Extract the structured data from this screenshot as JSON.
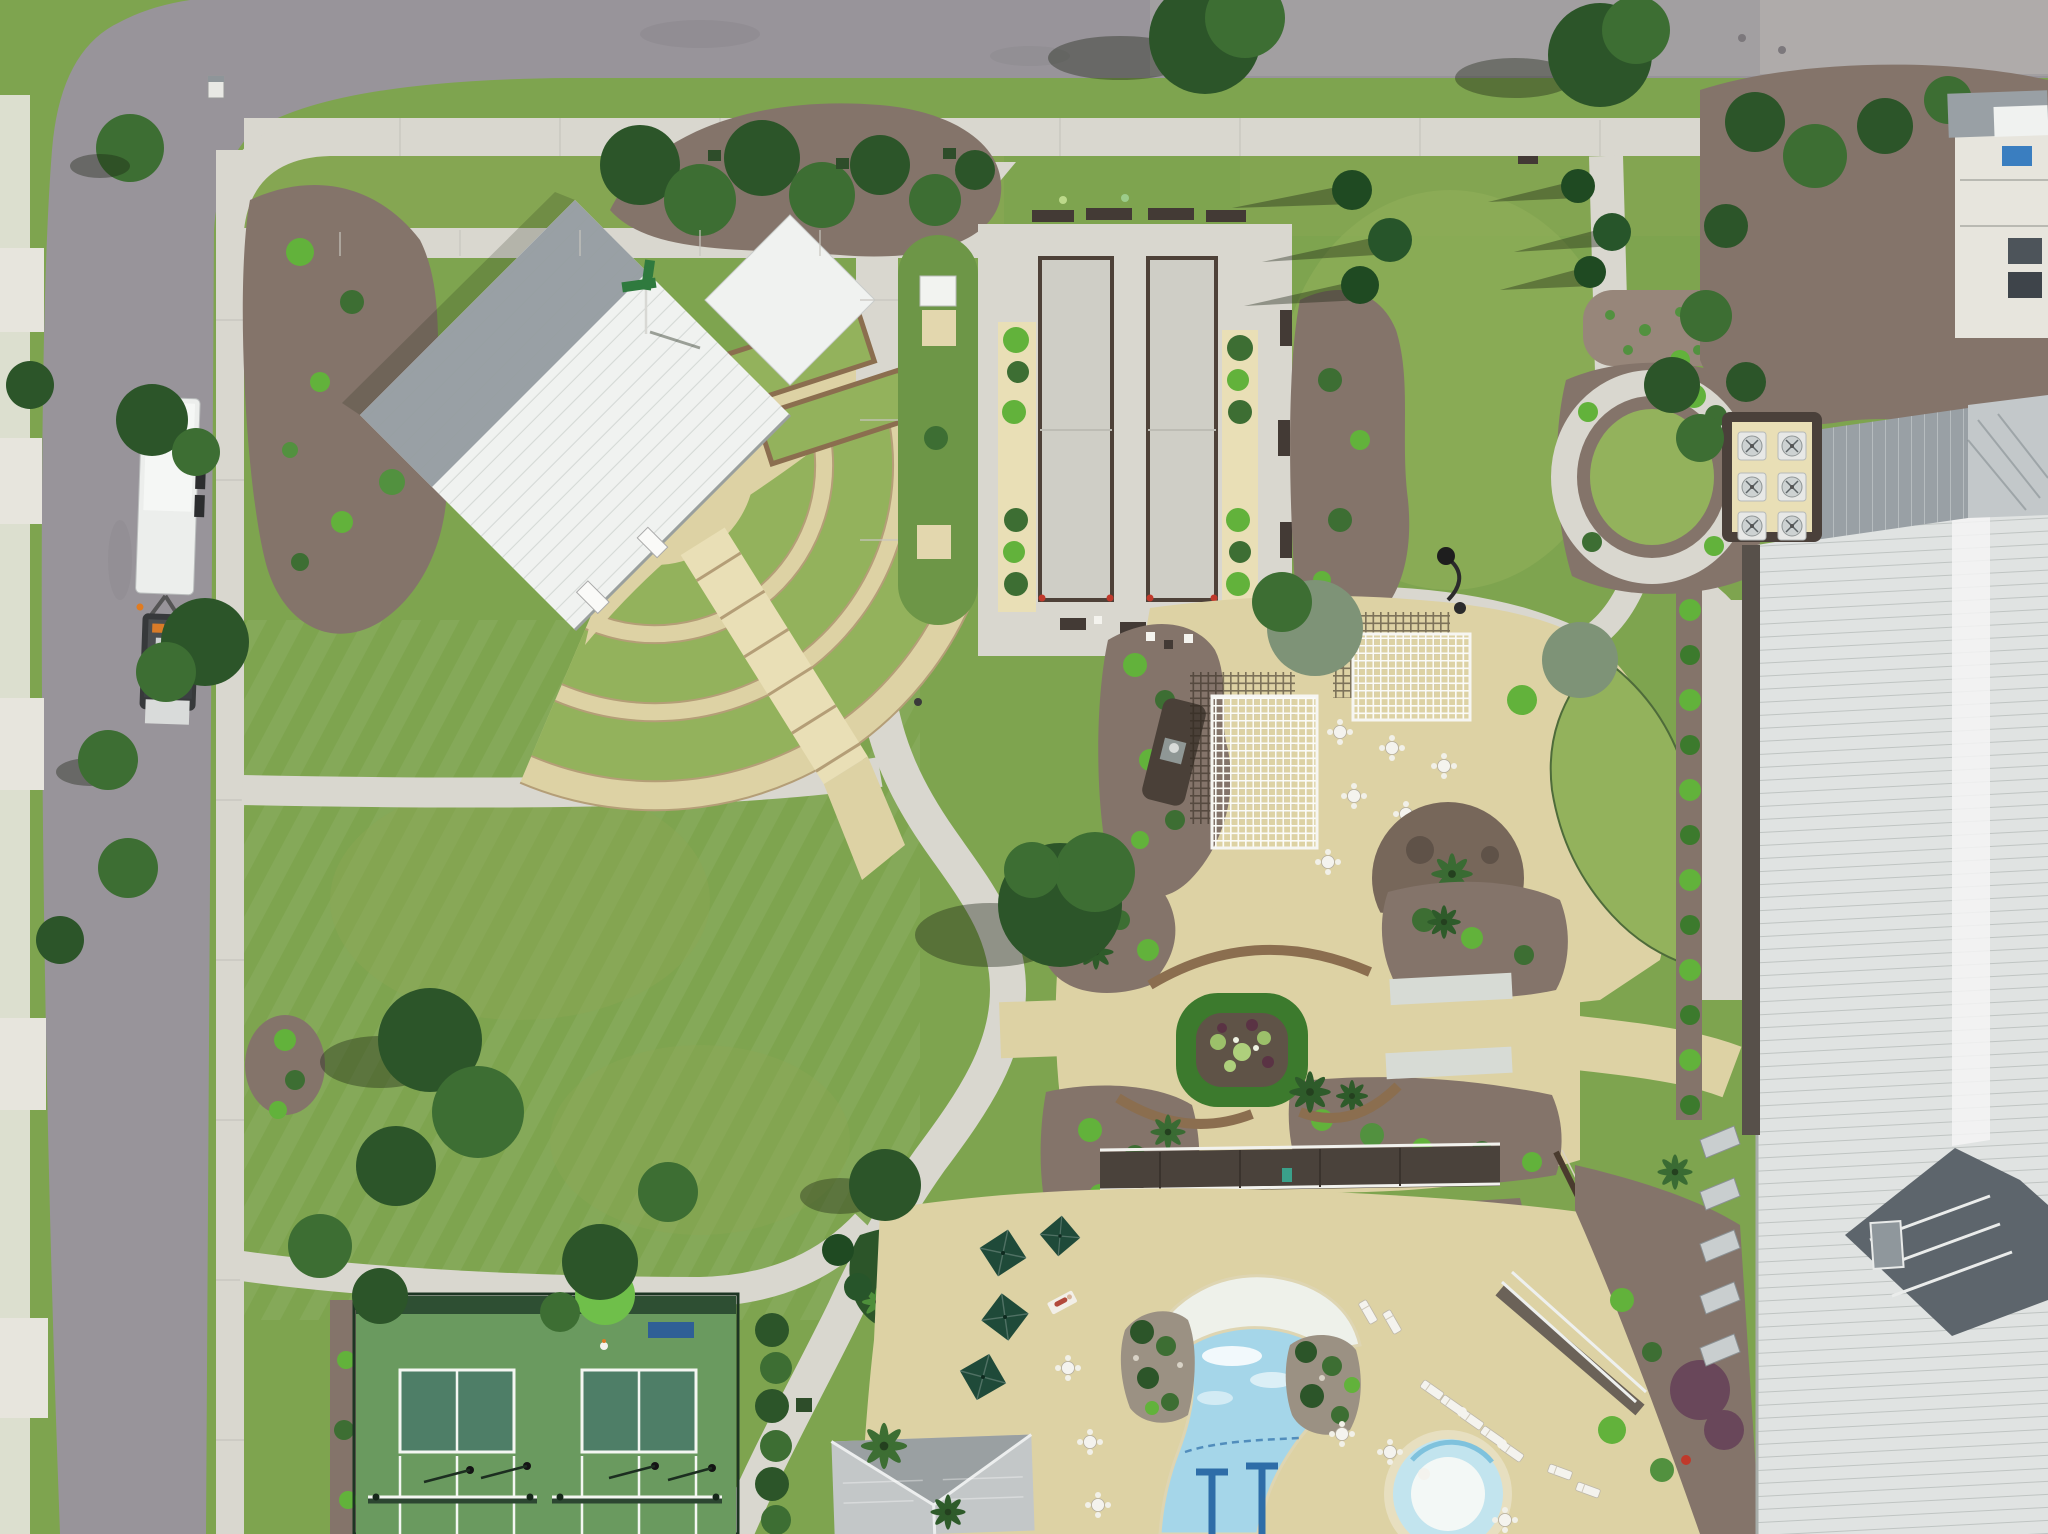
{
  "meta": {
    "title": "Aerial drone view of a community amenity campus",
    "description": "Top-down aerial photograph: amphitheater with white metal roof and terraced lawn seating, bocce courts, horseshoe lawn, white pergolas on a crushed-stone patio, formal garden with central planter, free-form swimming pool with beach entry and spa, tennis courts, clubhouse with standing-seam roof, roads, sidewalks, lawns and trees"
  },
  "palette": {
    "asphalt": "#98949a",
    "asphaltLight": "#aba7a7",
    "concrete": "#d9d7cf",
    "concreteBright": "#e7e5dd",
    "tan": "#ddd2a4",
    "tanBright": "#e9dfb6",
    "sand": "#e3d7ae",
    "grass": "#7ea44f",
    "grassLight": "#93b25c",
    "grassDark": "#6d9647",
    "grassOlive": "#8ba755",
    "mulch": "#84746a",
    "mulchLight": "#97867a",
    "treeDark": "#2c5529",
    "treeMid": "#3d6e33",
    "treeLight": "#52913f",
    "shrubBright": "#62b23b",
    "grayGreen": "#7e9377",
    "hedge": "#3c7a2d",
    "purpleShrub": "#69475a",
    "whiteRoof": "#f0f2f0",
    "grayRoof": "#99a0a5",
    "grayRoofLight": "#c3c8ca",
    "darkRoof": "#5d656c",
    "clubRoof": "#e0e3e2",
    "poolWater": "#a5d6e9",
    "laneBlue": "#2e6da8",
    "beach": "#eef1ea",
    "spaWater": "#c2e4ee",
    "courtOuter": "#6a9a5f",
    "courtInner": "#4e7e67",
    "courtLine": "#f4f6f2",
    "seatWall": "#8b6e4f",
    "gravelWhite": "#d7dbd5",
    "benchDark": "#433a35",
    "tableWhite": "#f4f3ee",
    "umbrella": "#1f4a39",
    "truckWhite": "#eceeec",
    "truckDark": "#37393b",
    "signGreen": "#2f7a3e",
    "binBlue": "#3a7ec0",
    "bannerBlue": "#2f5f96",
    "shadow": "rgba(25,35,18,0.38)"
  },
  "scene": {
    "features": [
      {
        "name": "amphitheater",
        "desc": "white metal roof pavilion with fan of terraced lawn seating"
      },
      {
        "name": "bocce-courts",
        "desc": "two long gray courts with shrub borders and benches"
      },
      {
        "name": "horseshoe-lawn",
        "desc": "lawn strip with equipment shed and two sand pits"
      },
      {
        "name": "pergola-patio",
        "desc": "two white lattice pergolas, outdoor fireplace, umbrella tables"
      },
      {
        "name": "formal-garden",
        "desc": "central hedge planter, curved seat walls, white gravel bands, palms"
      },
      {
        "name": "pool",
        "desc": "free-form pool with beach entry, lap lanes, rock islands and round spa"
      },
      {
        "name": "tennis-courts",
        "desc": "two green courts with white lines and dark fencing"
      },
      {
        "name": "clubhouse",
        "desc": "large building with light standing-seam roof, dark gable and rooftop HVAC"
      },
      {
        "name": "roads",
        "desc": "asphalt street corner with sidewalks and a landscaping truck with trailer"
      }
    ]
  }
}
